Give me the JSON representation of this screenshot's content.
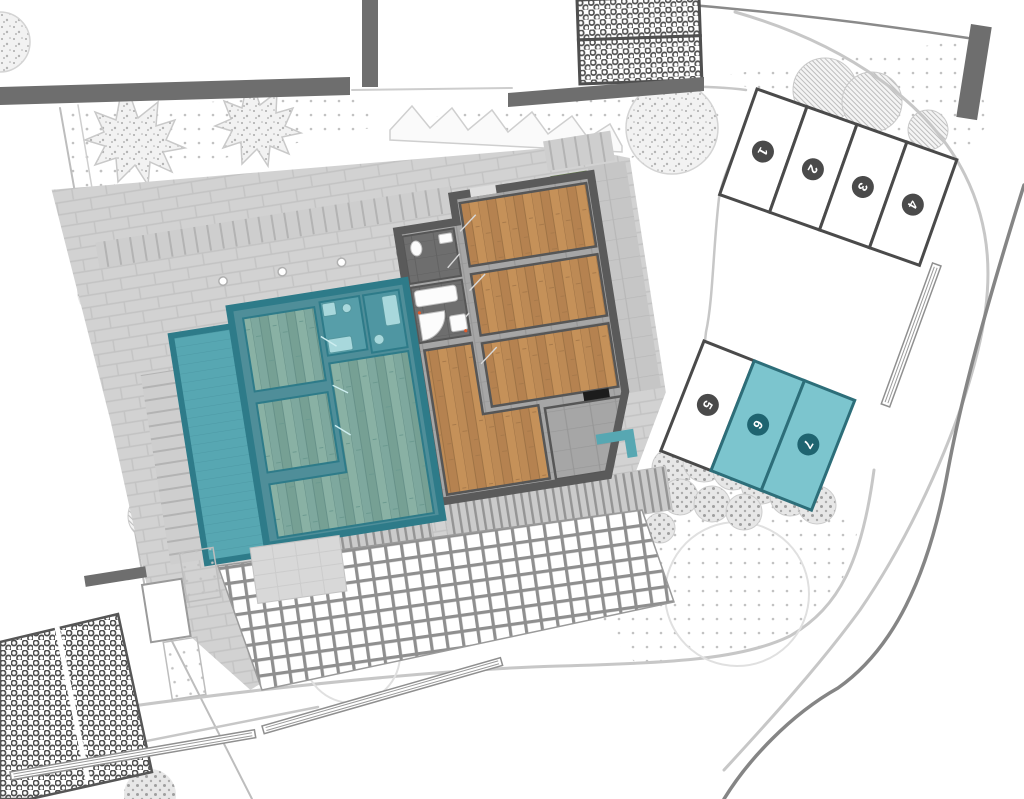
{
  "site_plan": {
    "description": "residential site plan with highlighted apartment unit and parking stalls",
    "parking": {
      "rows": [
        {
          "name": "upper-row",
          "spaces": [
            {
              "number": "1",
              "highlighted": false
            },
            {
              "number": "2",
              "highlighted": false
            },
            {
              "number": "3",
              "highlighted": false
            },
            {
              "number": "4",
              "highlighted": false
            }
          ]
        },
        {
          "name": "side-row",
          "spaces": [
            {
              "number": "5",
              "highlighted": false
            },
            {
              "number": "6",
              "highlighted": true
            },
            {
              "number": "7",
              "highlighted": true
            }
          ]
        }
      ]
    },
    "colors": {
      "highlight_fill": "#7cc5ce",
      "highlight_border": "#2d6e79",
      "highlight_badge": "#1f6470",
      "neutral_badge": "#4a4a4a",
      "apartment_wall_teal": "#2e7b89",
      "terrace_teal": "#57a7b2",
      "wood_floor": "#bd8a55",
      "building_wall": "#5a5a5a",
      "planter_green": "#7fa352"
    }
  }
}
